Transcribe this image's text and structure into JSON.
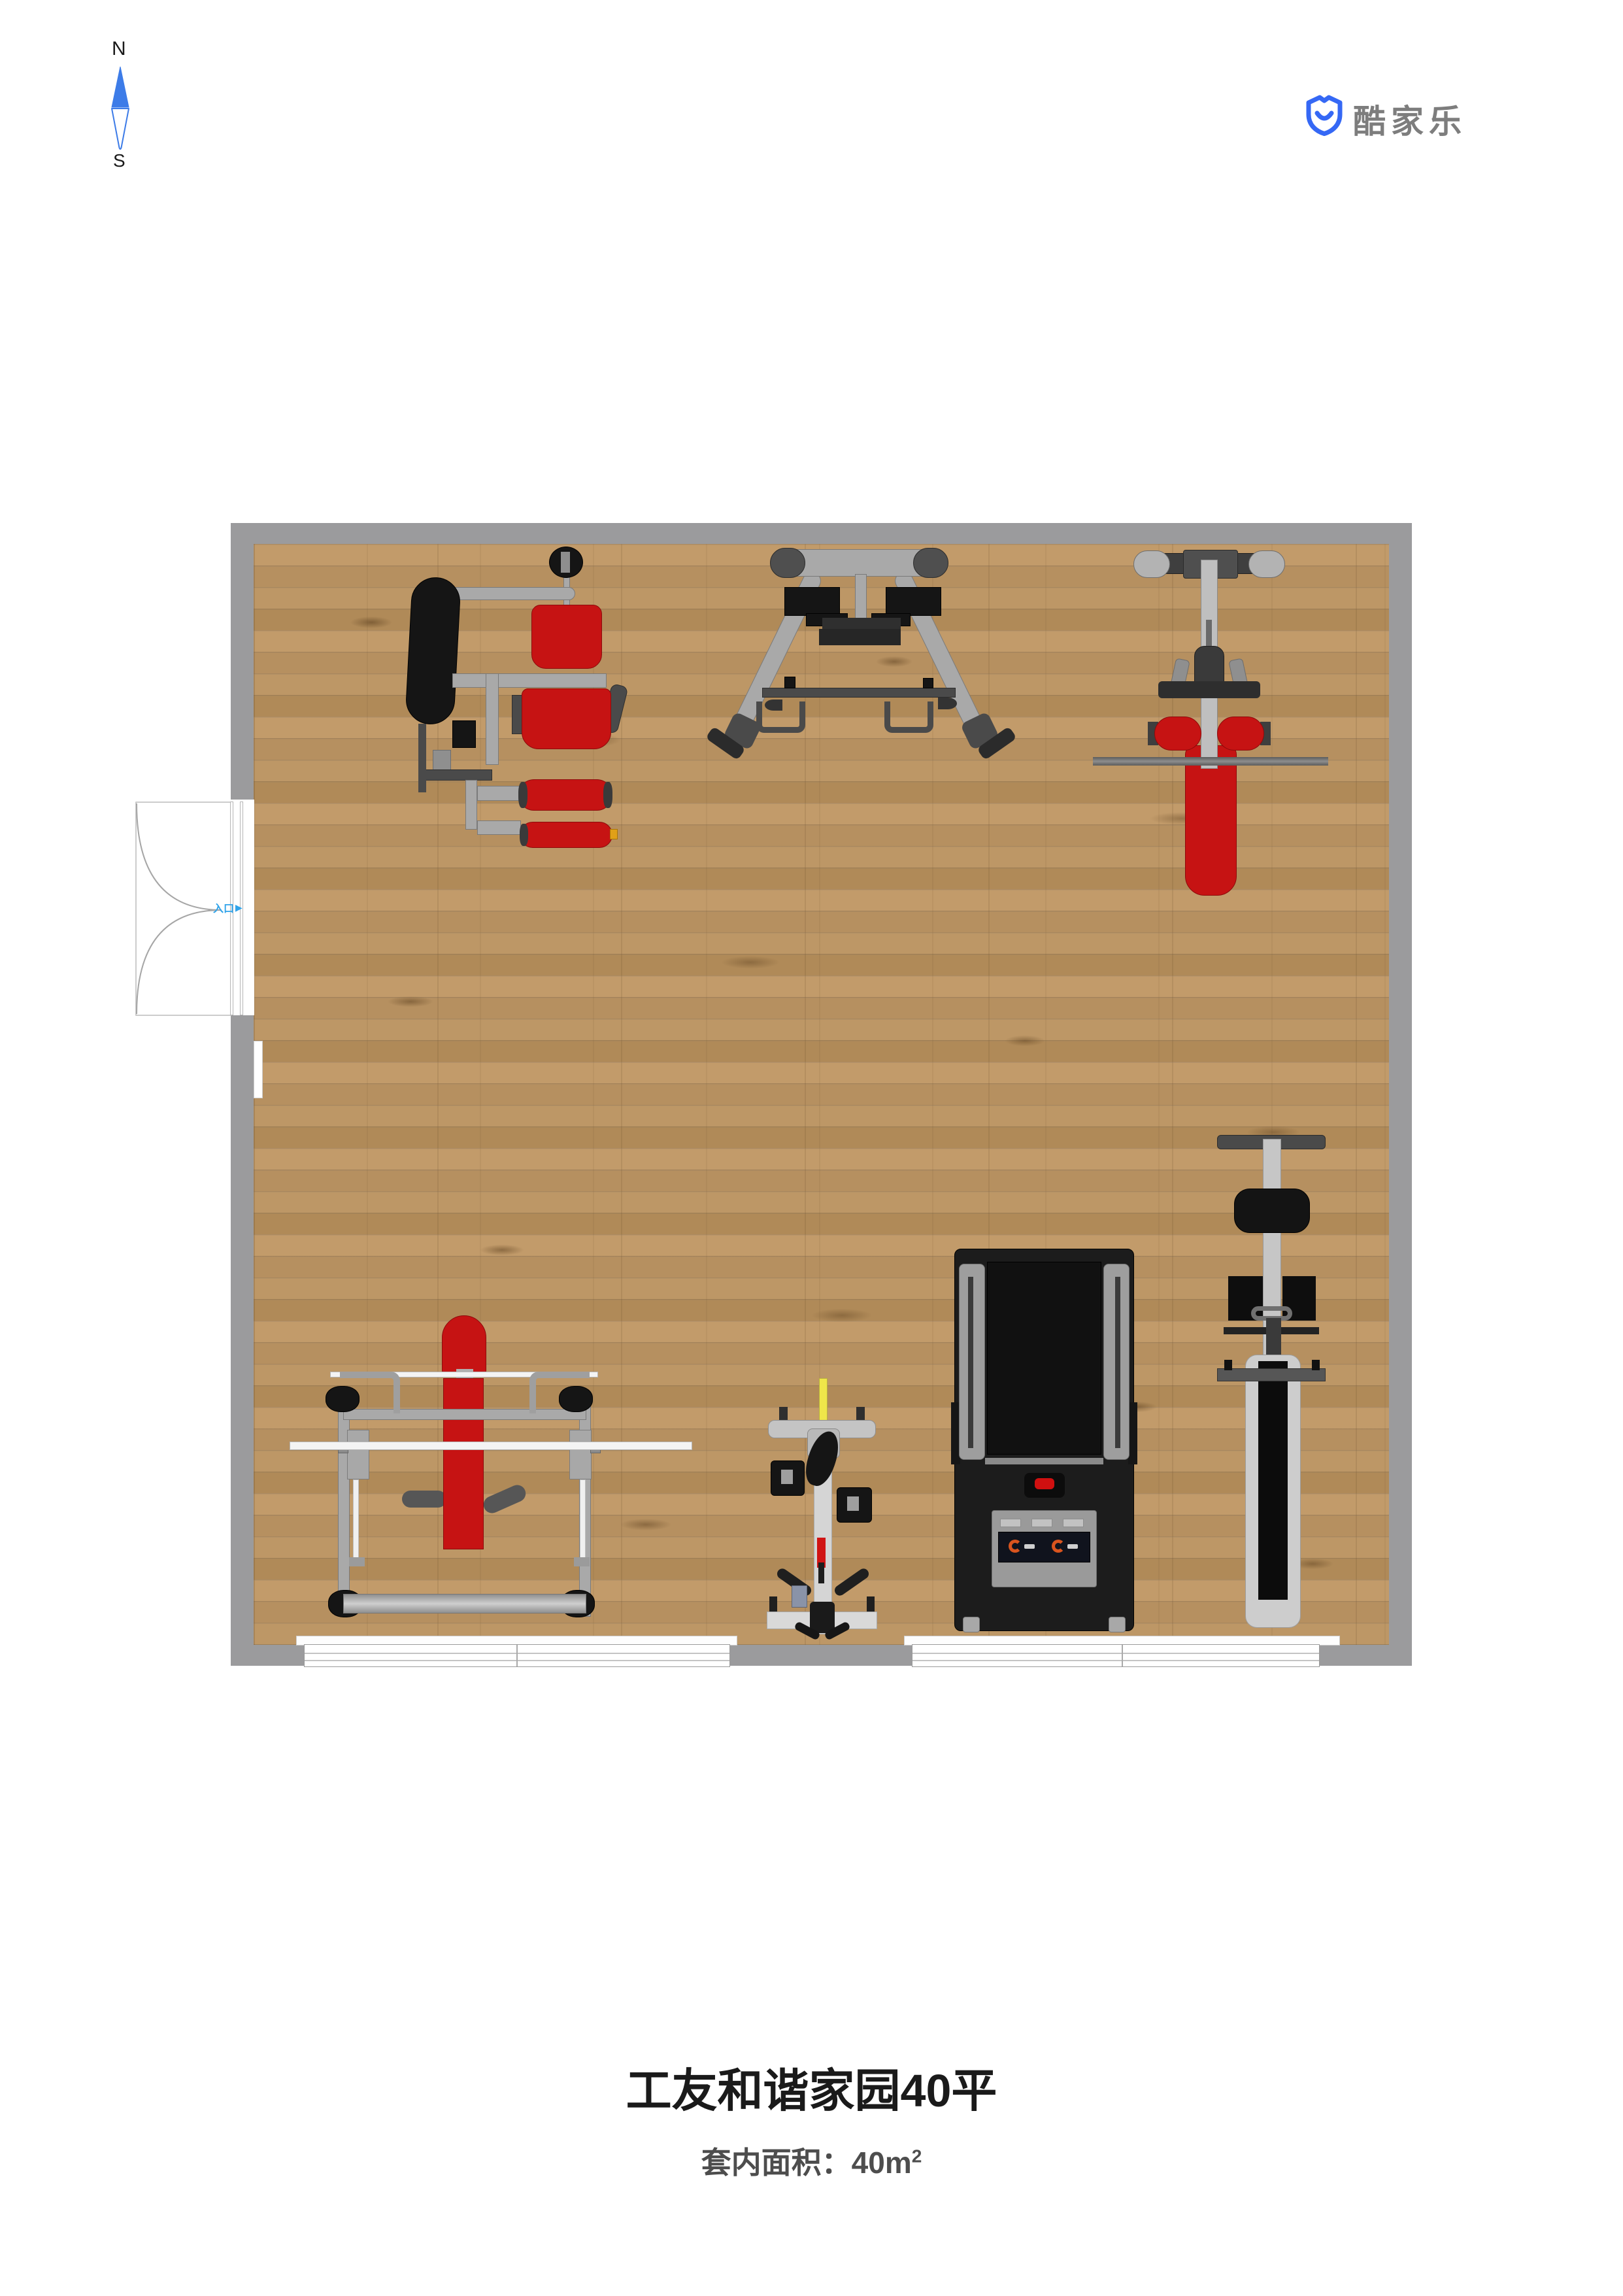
{
  "compass": {
    "north": "N",
    "south": "S",
    "needle_blue": "#3D7CE8"
  },
  "brand": {
    "name": "酷家乐",
    "icon": "kujiale-shield-smile-icon",
    "icon_blue": "#3568F5",
    "text_gray": "#7D7D7D"
  },
  "plan": {
    "wall_color": "#9B9B9D",
    "floor_color": "#BA9465",
    "entrance": {
      "label": "入口",
      "arrow": "▶",
      "color": "#2FA3EA"
    },
    "door": {
      "type": "double-swing-door",
      "wall": "west"
    },
    "windows": [
      {
        "id": "south-window-left"
      },
      {
        "id": "south-window-right"
      }
    ],
    "equipment": [
      {
        "id": "multi-station-gym",
        "position": "north-west",
        "colors": [
          "#A9A9A9",
          "#C61313",
          "#151515"
        ]
      },
      {
        "id": "a-frame-rack",
        "position": "north-center",
        "colors": [
          "#ABABAB",
          "#2F2F2F"
        ]
      },
      {
        "id": "lat-pulldown-machine",
        "position": "north-east",
        "colors": [
          "#BFBFBF",
          "#C61313"
        ]
      },
      {
        "id": "bench-press-rack",
        "position": "south-west",
        "colors": [
          "#A8A8A8",
          "#C61313",
          "#F4F4F4"
        ]
      },
      {
        "id": "exercise-bike",
        "position": "south-center",
        "colors": [
          "#D5D5D5",
          "#EFE64A",
          "#1A1A1A"
        ]
      },
      {
        "id": "treadmill",
        "position": "south-center-east",
        "colors": [
          "#1C1C1C",
          "#9E9E9E",
          "#D01010",
          "#D9541E"
        ]
      },
      {
        "id": "weight-bench-machine",
        "position": "south-east",
        "colors": [
          "#C6C6C6",
          "#141414"
        ]
      }
    ]
  },
  "footer": {
    "title": "工友和谐家园40平",
    "area_label": "套内面积：40",
    "area_unit": "m",
    "area_sup": "2"
  }
}
